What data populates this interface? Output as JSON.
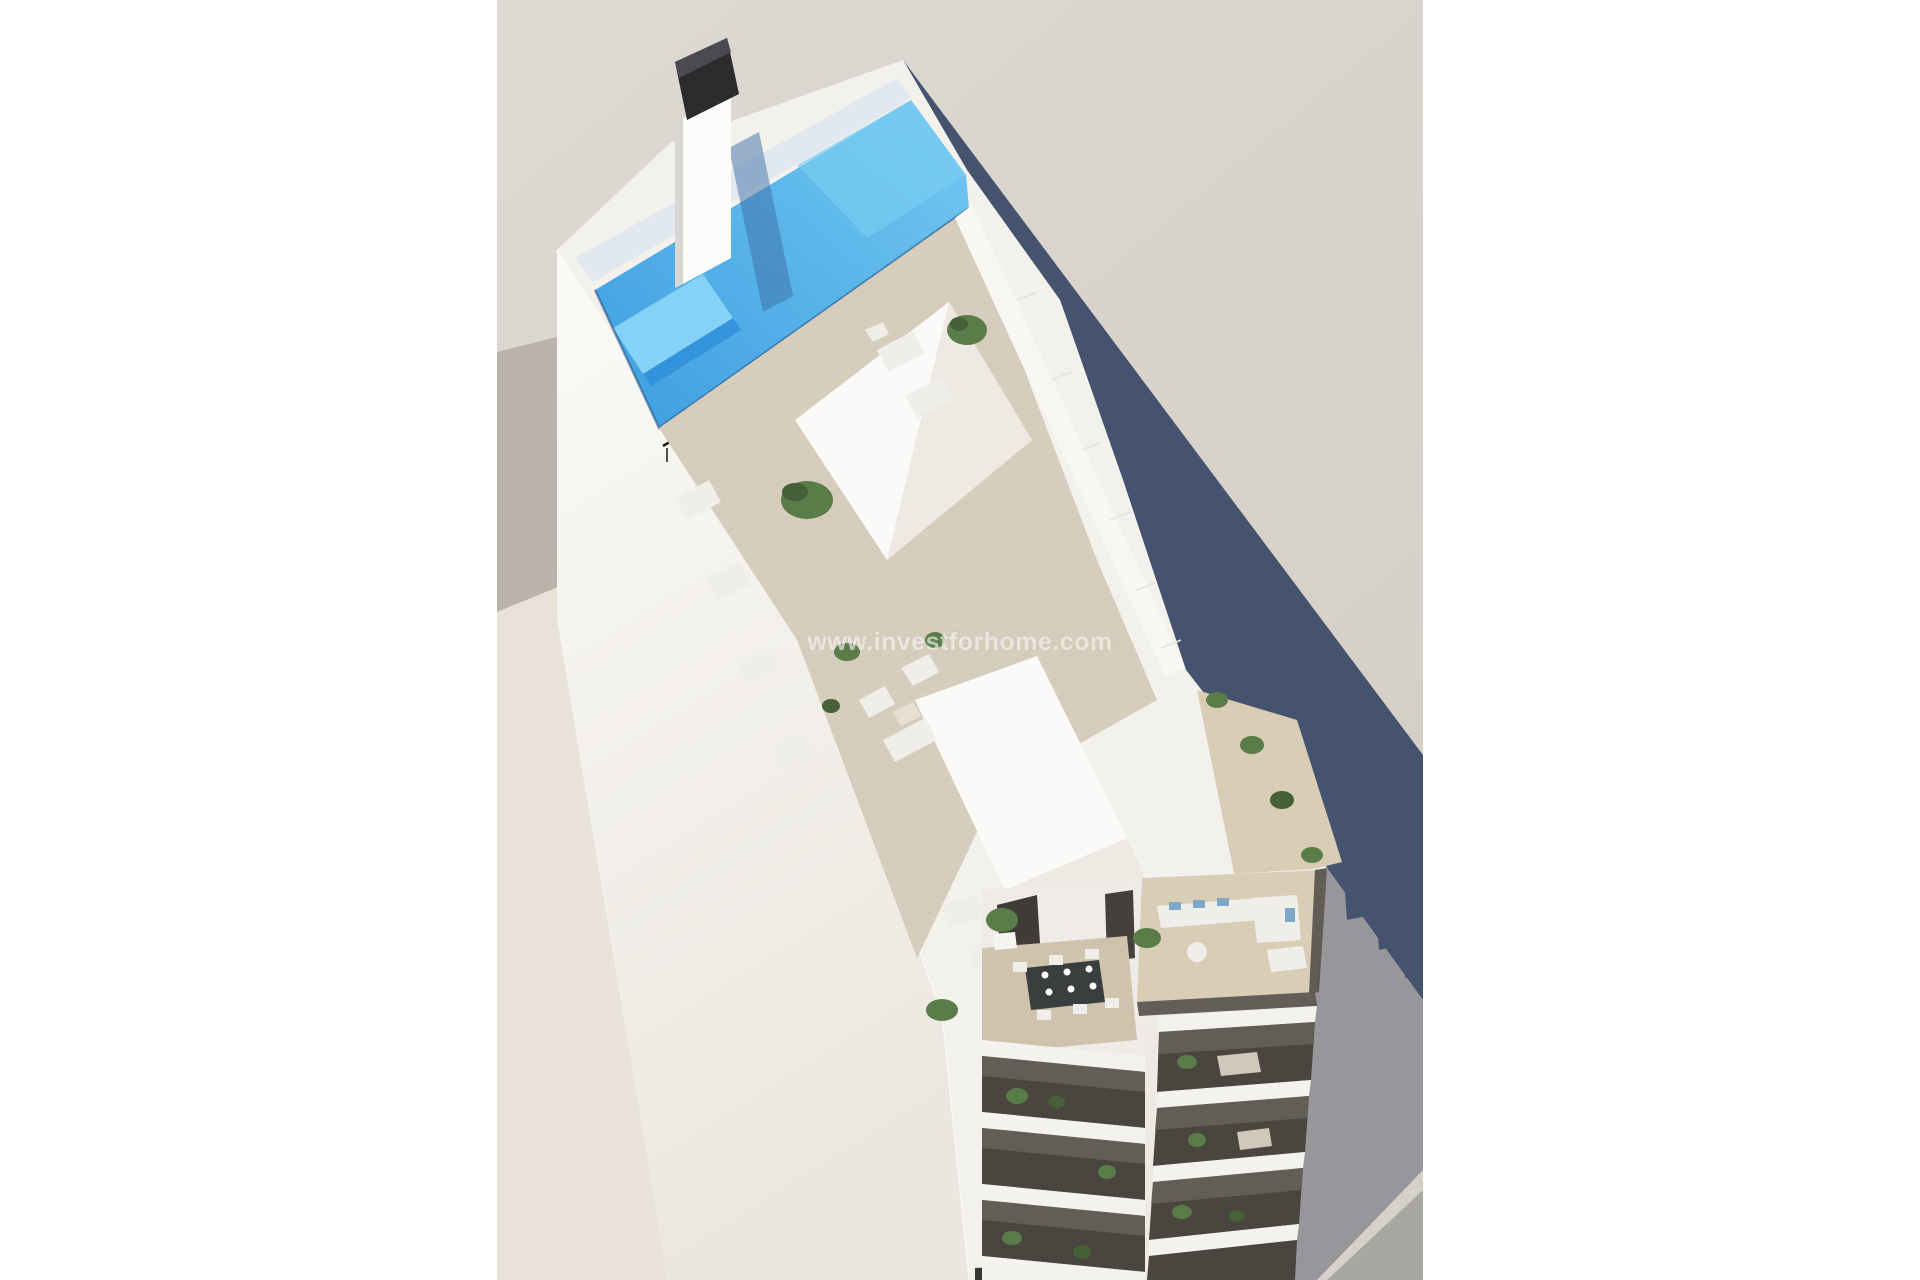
{
  "watermark": {
    "text": "www.investforhome.com"
  },
  "photo": {
    "alt": "Aerial 3D architectural rendering of a narrow white apartment building with a rooftop swimming pool, sun terraces with loungers and plants, and stacked balconies above a tiled sidewalk"
  },
  "palette": {
    "page_bg": "#ffffff",
    "bg_top": "#ddd9d3",
    "bg_bottom": "#d3cec6",
    "neighbor_roof": "#b9b3ab",
    "ground_cream": "#e8e2d8",
    "sidewalk": "#d7d2c9",
    "road": "#a9a7a3",
    "shadow_dark": "#46536f",
    "shadow_medium": "#97969a",
    "wall_light": "#fbfaf7",
    "wall_shade": "#ebe7e0",
    "roof_white": "#f3f1ec",
    "facade_base": "#efece7",
    "parapet_white": "#f9f7f3",
    "pool_pale": "#e2e8f0",
    "water_light": "#79ccf3",
    "water_main": "#49b1ea",
    "water_deep": "#2f8fd9",
    "water_shallow": "#85d2f6",
    "water_rim": "#1e3f72",
    "chimney_shadow": "#3e6da6",
    "chimney_dark": "#2c2b2d",
    "chimney_cap_top": "#4b4a4e",
    "chimney_light": "#fcfcfb",
    "chimney_side": "#d9d7d3",
    "volume_white": "#fbfaf8",
    "volume_shade": "#edeae3",
    "deck_tan": "#d6cdbc",
    "deck_warm": "#d9cdb6",
    "dining_floor": "#cfc3ae",
    "plant_green": "#5a7c48",
    "plant_dark": "#46613a",
    "balcony_dark": "#4a463f",
    "balcony_glass": "#6b665e",
    "slab_white": "#f4f2ee",
    "furn_white": "#f0eeea",
    "lounger_pad": "#cfc8bb",
    "sofa_blue": "#7fa8c8",
    "table_dark": "#3a3e3f",
    "railing_dark": "#57534c",
    "rail_black": "#1c1c1c",
    "pier": "#edeae4",
    "door_dark": "#3f3c38",
    "door_dark2": "#44413c",
    "garage_dark": "#3a3835",
    "joint_line": "#e6e3dc",
    "edge_highlight": "#ffffff"
  }
}
